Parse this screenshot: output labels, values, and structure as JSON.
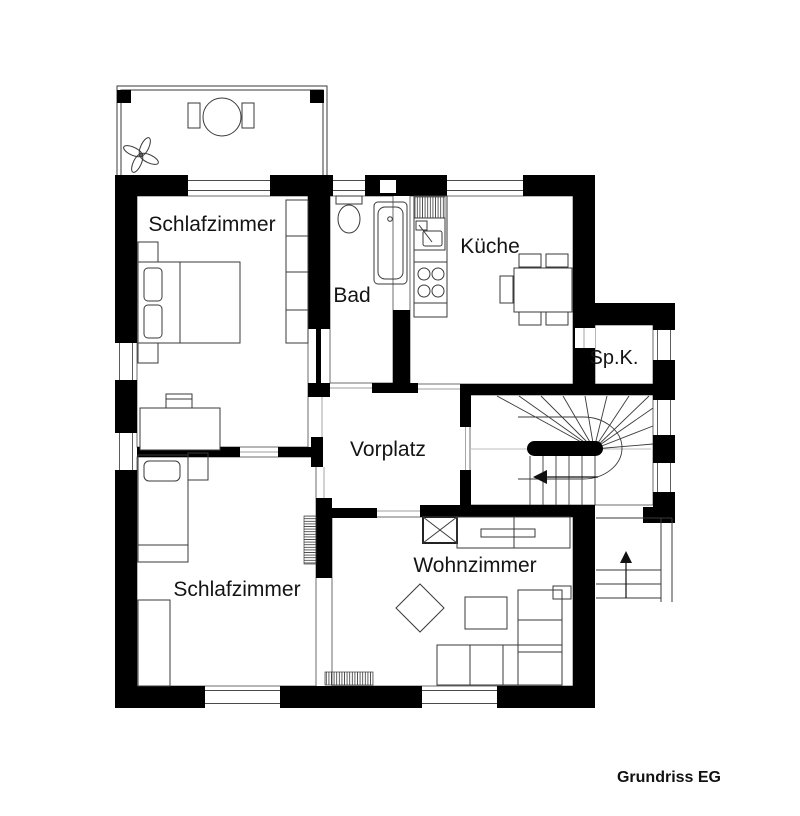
{
  "plan": {
    "caption": "Grundriss EG",
    "rooms": [
      {
        "id": "bedroom-top",
        "label": "Schlafzimmer"
      },
      {
        "id": "bathroom",
        "label": "Bad"
      },
      {
        "id": "kitchen",
        "label": "Küche"
      },
      {
        "id": "pantry",
        "label": "Sp.K."
      },
      {
        "id": "hallway",
        "label": "Vorplatz"
      },
      {
        "id": "bedroom-bottom",
        "label": "Schlafzimmer"
      },
      {
        "id": "living-room",
        "label": "Wohnzimmer"
      }
    ],
    "colors": {
      "wall": "#000000",
      "background": "#ffffff",
      "furniture_line": "#3a3a3a"
    }
  }
}
